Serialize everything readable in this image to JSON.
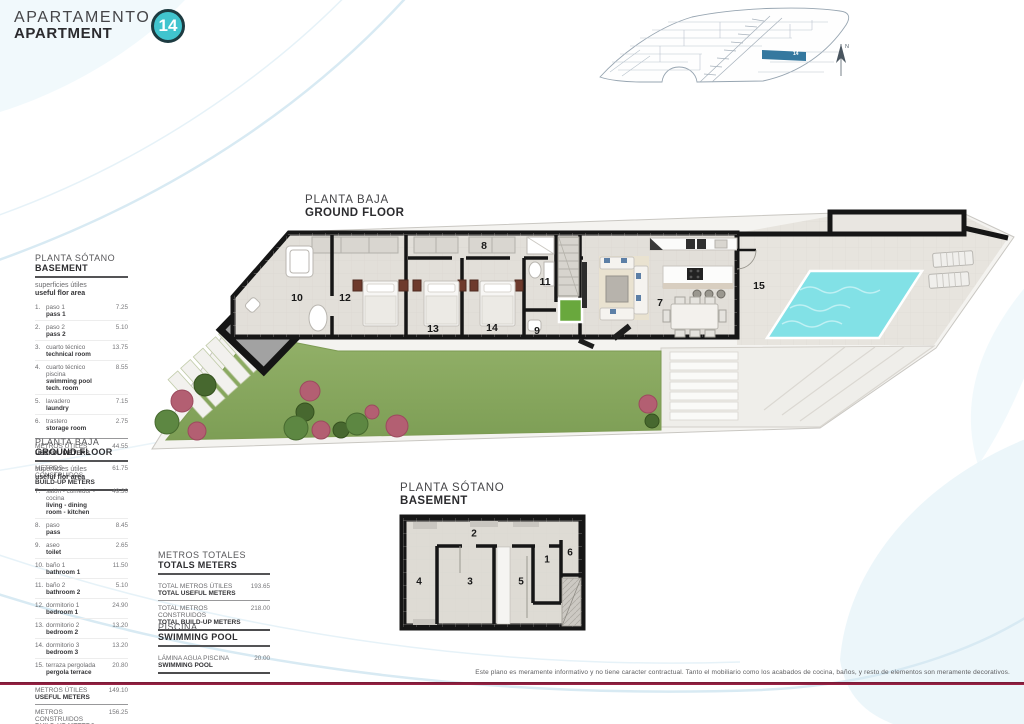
{
  "header": {
    "title_line1": "APARTAMENTO",
    "title_line2": "APARTMENT",
    "unit_number": "14"
  },
  "site_plan": {
    "highlighted_unit": "14",
    "compass": "N"
  },
  "plan_labels": {
    "ground": {
      "es": "PLANTA BAJA",
      "en": "GROUND FLOOR"
    },
    "basement": {
      "es": "PLANTA SÓTANO",
      "en": "BASEMENT"
    }
  },
  "ground_rooms": [
    {
      "n": "8",
      "x": 484,
      "y": 246
    },
    {
      "n": "10",
      "x": 297,
      "y": 298
    },
    {
      "n": "12",
      "x": 345,
      "y": 298
    },
    {
      "n": "13",
      "x": 433,
      "y": 329
    },
    {
      "n": "14",
      "x": 492,
      "y": 328
    },
    {
      "n": "11",
      "x": 545,
      "y": 282
    },
    {
      "n": "9",
      "x": 537,
      "y": 331
    },
    {
      "n": "7",
      "x": 660,
      "y": 303
    },
    {
      "n": "15",
      "x": 759,
      "y": 286
    }
  ],
  "basement_rooms": [
    {
      "n": "2",
      "x": 474,
      "y": 534
    },
    {
      "n": "4",
      "x": 419,
      "y": 582
    },
    {
      "n": "3",
      "x": 470,
      "y": 582
    },
    {
      "n": "5",
      "x": 521,
      "y": 582
    },
    {
      "n": "1",
      "x": 547,
      "y": 560
    },
    {
      "n": "6",
      "x": 570,
      "y": 553
    }
  ],
  "basement_table": {
    "title_es": "PLANTA SÓTANO",
    "title_en": "BASEMENT",
    "subtitle_es": "superficies útiles",
    "subtitle_en": "useful flor area",
    "rows": [
      {
        "num": "1.",
        "es": "paso 1",
        "en": "pass 1",
        "value": "7.25"
      },
      {
        "num": "2.",
        "es": "paso 2",
        "en": "pass 2",
        "value": "5.10"
      },
      {
        "num": "3.",
        "es": "cuarto técnico",
        "en": "technical room",
        "value": "13.75"
      },
      {
        "num": "4.",
        "es": "cuarto técnico piscina",
        "en": "swimming pool tech. room",
        "value": "8.55"
      },
      {
        "num": "5.",
        "es": "lavadero",
        "en": "laundry",
        "value": "7.15"
      },
      {
        "num": "6.",
        "es": "trastero",
        "en": "storage room",
        "value": "2.75"
      }
    ],
    "totals": [
      {
        "es": "METROS ÚTILES",
        "en": "USEFUL METERS",
        "value": "44.55"
      },
      {
        "es": "METROS CONSTRUIDOS",
        "en": "BUILD-UP METERS",
        "value": "61.75"
      }
    ]
  },
  "ground_table": {
    "title_es": "PLANTA BAJA",
    "title_en": "GROUND FLOOR",
    "subtitle_es": "superficies útiles",
    "subtitle_en": "useful flor area",
    "rows": [
      {
        "num": "7.",
        "es": "salón - comedor - cocina",
        "en": "living - dining room - kitchen",
        "value": "49.30"
      },
      {
        "num": "8.",
        "es": "paso",
        "en": "pass",
        "value": "8.45"
      },
      {
        "num": "9.",
        "es": "aseo",
        "en": "toilet",
        "value": "2.65"
      },
      {
        "num": "10.",
        "es": "baño 1",
        "en": "bathroom 1",
        "value": "11.50"
      },
      {
        "num": "11.",
        "es": "baño 2",
        "en": "bathroom 2",
        "value": "5.10"
      },
      {
        "num": "12.",
        "es": "dormitorio 1",
        "en": "bedroom 1",
        "value": "24.90"
      },
      {
        "num": "13.",
        "es": "dormitorio 2",
        "en": "bedroom 2",
        "value": "13.20"
      },
      {
        "num": "14.",
        "es": "dormitorio 3",
        "en": "bedroom 3",
        "value": "13.20"
      },
      {
        "num": "15.",
        "es": "terraza pergolada",
        "en": "pergola terrace",
        "value": "20.80"
      }
    ],
    "totals": [
      {
        "es": "METROS ÚTILES",
        "en": "USEFUL METERS",
        "value": "149.10"
      },
      {
        "es": "METROS CONSTRUIDOS",
        "en": "BUILD-UP METERS",
        "value": "156.25"
      }
    ]
  },
  "totals_table": {
    "title_es": "METROS TOTALES",
    "title_en": "TOTALS METERS",
    "rows": [
      {
        "es": "TOTAL METROS ÚTILES",
        "en": "TOTAL USEFUL METERS",
        "value": "193.65"
      },
      {
        "es": "TOTAL METROS CONSTRUIDOS",
        "en": "TOTAL BUILD-UP METERS",
        "value": "218.00"
      }
    ]
  },
  "pool_table": {
    "title_es": "PISCINA",
    "title_en": "SWIMMING POOL",
    "rows": [
      {
        "es": "LÁMINA AGUA PISCINA",
        "en": "SWIMMING POOL",
        "value": "20.00"
      }
    ]
  },
  "footer": {
    "disclaimer": "Este plano es meramente informativo y no tiene caracter contractual. Tanto el mobiliario como los acabados de cocina, baños, y resto de elementos son meramente decorativos."
  },
  "colors": {
    "accent_teal": "#41c4ce",
    "highlight_blue": "#35789f",
    "footer_line": "#96203f",
    "pool_water": "#82e1e6"
  }
}
